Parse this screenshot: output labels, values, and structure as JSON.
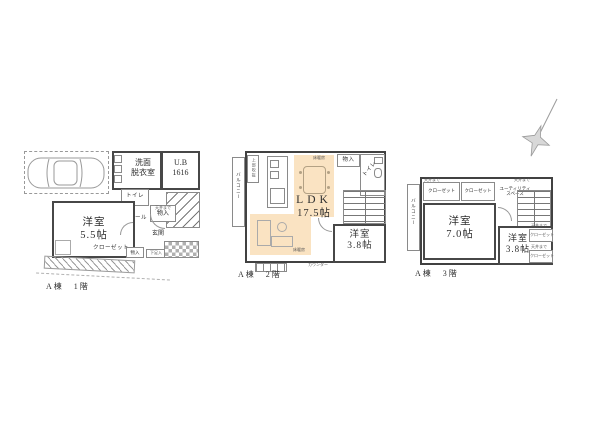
{
  "colors": {
    "hl": "#fae3c2"
  },
  "floor1": {
    "label": "A棟　1階",
    "washroom_l1": "洗面",
    "washroom_l2": "脱衣室",
    "bath_l1": "U.B",
    "bath_l2": "1616",
    "toilet": "トイレ",
    "storage_note": "天井まで",
    "storage_upper": "物入",
    "hall": "ホール",
    "entrance": "玄関",
    "room_l1": "洋室",
    "room_l2": "5.5帖",
    "closet": "クローゼット",
    "storage_lower": "物入",
    "shoe_box": "下足入"
  },
  "floor2": {
    "label": "A棟　2階",
    "balcony": "バルコニー",
    "void_above": "上部吹抜",
    "storage": "物入",
    "toilet": "トイレ",
    "ldk_l1": "LDK",
    "ldk_l2": "17.5帖",
    "heat_note1": "床暖房",
    "heat_note2": "床暖房",
    "room_l1": "洋室",
    "room_l2": "3.8帖",
    "counter": "カウンター"
  },
  "floor3": {
    "label": "A棟　3階",
    "balcony": "バルコニー",
    "closet1_note": "天井まで",
    "closet1": "クローゼット",
    "closet2": "クローゼット",
    "utility_note": "天井まで",
    "utility_l1": "ユーティリティ",
    "utility_l2": "スペース",
    "room7_l1": "洋室",
    "room7_l2": "7.0帖",
    "room38_l1": "洋室",
    "room38_l2": "3.8帖",
    "closet3_note": "天井まで",
    "closet3": "クローゼット",
    "closet4_note": "天井まで",
    "closet4": "クローゼット"
  }
}
